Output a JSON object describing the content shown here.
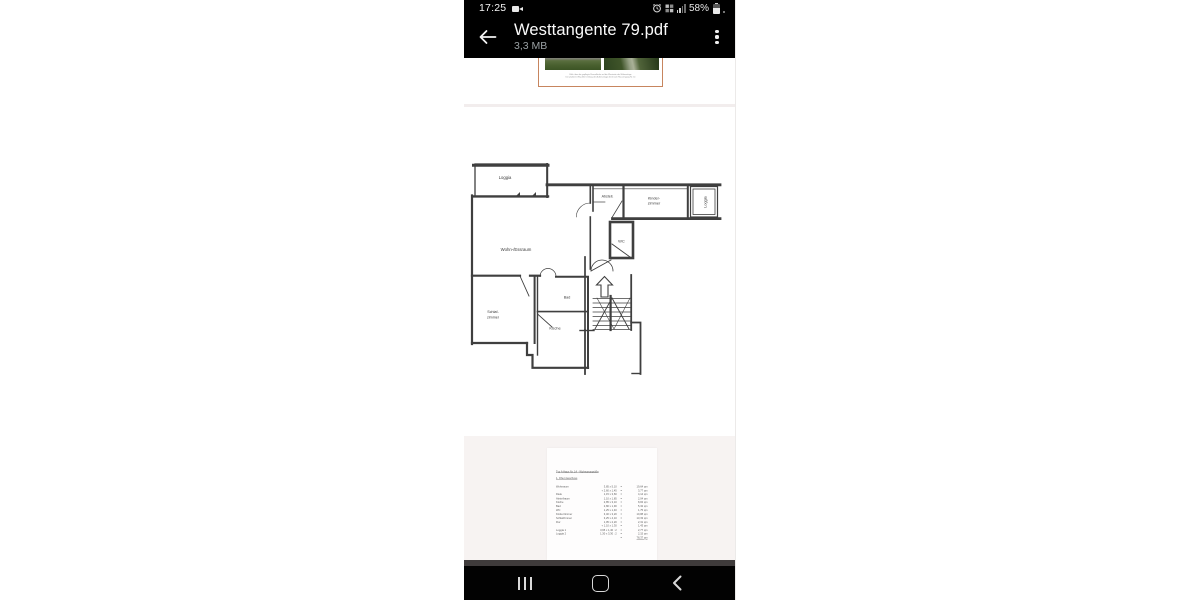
{
  "status_bar": {
    "time": "17:25",
    "battery_percent": "58%",
    "icons": {
      "left": "video-camera-icon",
      "right": [
        "alarm-icon",
        "volte-icon",
        "signal-icon",
        "battery-icon"
      ]
    }
  },
  "header": {
    "title": "Westtangente 79.pdf",
    "file_size": "3,3 MB",
    "back_icon": "arrow-left-icon",
    "menu_icon": "overflow-menu-icon"
  },
  "viewer": {
    "page1": {
      "caption_line1": "Blick über die gepflegte Rasenfläche auf die Westseite der Wohnanlage",
      "caption_line2": "Der plattierte Weg führt entlang der Außenanlage direkt zum Hauseingang Nr. 14"
    },
    "floor_plan": {
      "loggia_left": "Loggia",
      "abstell": "Abstell.",
      "kinderzimmer_line1": "Kinder-",
      "kinderzimmer_line2": "zimmer",
      "loggia_right": "Loggia",
      "wc": "WC",
      "wohnraum": "Wohn-/Essraum",
      "schlafzimmer_line1": "Schlaf-",
      "schlafzimmer_line2": "zimmer",
      "bad": "Bad",
      "kueche": "Küche"
    },
    "page3": {
      "heading": "Typ A  Haus Nr. 14  -  Wohnungsgröße",
      "subheading": "1. Ober-Geschoss",
      "rows": [
        {
          "name": "Wohnraum",
          "dims": "3,85 x 5,10",
          "eq": "=",
          "area": "19,64 qm"
        },
        {
          "name": "",
          "dims": "+ 2,60 x 1,45",
          "eq": "=",
          "area": "3,77 qm"
        },
        {
          "name": "Diele",
          "dims": "1,15 x 3,60",
          "eq": "=",
          "area": "4,14 qm"
        },
        {
          "name": "Abstellraum",
          "dims": "1,10 x 1,85",
          "eq": "=",
          "area": "2,04 qm"
        },
        {
          "name": "Küche",
          "dims": "2,85 x 3,10",
          "eq": "=",
          "area": "8,84 qm"
        },
        {
          "name": "Bad",
          "dims": "2,80 x 1,90",
          "eq": "=",
          "area": "5,32 qm"
        },
        {
          "name": "WC",
          "dims": "1,25 x 1,40",
          "eq": "=",
          "area": "1,75 qm"
        },
        {
          "name": "Kinderzimmer",
          "dims": "3,40 x 3,20",
          "eq": "=",
          "area": "10,88 qm"
        },
        {
          "name": "Schlafzimmer",
          "dims": "3,25 x 4,10",
          "eq": "=",
          "area": "13,33 qm"
        },
        {
          "name": "Flur",
          "dims": "1,05 x 2,20",
          "eq": "=",
          "area": "2,31 qm"
        },
        {
          "name": "",
          "dims": "+ 1,10 x 1,30",
          "eq": "=",
          "area": "1,43 qm"
        },
        {
          "name": "Loggia 1",
          "dims": "3,95 x 1,40 : 2",
          "eq": "=",
          "area": "2,77 qm"
        },
        {
          "name": "Loggia 2",
          "dims": "1,30 x 3,30 : 2",
          "eq": "=",
          "area": "2,15 qm"
        },
        {
          "name": "",
          "dims": "",
          "eq": "=",
          "area": "78,37 qm",
          "total": true
        }
      ]
    }
  },
  "nav_bar": {
    "recents_icon": "recents-icon",
    "home_icon": "home-icon",
    "back_icon": "back-icon"
  },
  "colors": {
    "topbar": "#000000",
    "navbar": "#020202",
    "photo_box_border": "#c7855e",
    "plan_ink": "#3f3f3f"
  }
}
